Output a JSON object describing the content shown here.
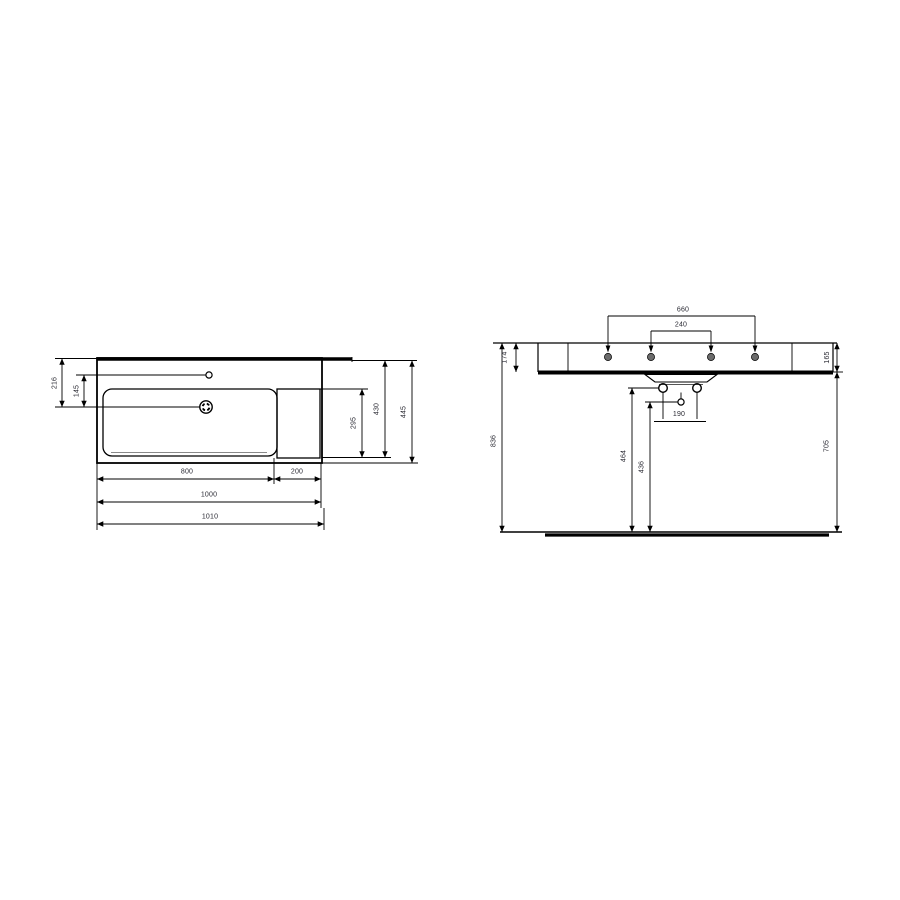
{
  "drawing": {
    "subject": "wall-hung washbasin technical drawing (plan view and front elevation)",
    "plan": {
      "bowl_width": "800",
      "deck_width": "200",
      "basin_width": "1000",
      "overall_width": "1010",
      "rear_to_drain": "216",
      "tap_to_drain": "145",
      "bowl_depth": "295",
      "inner_depth": "430",
      "overall_depth": "445"
    },
    "front": {
      "tap_hole_span": "660",
      "tap_hole_inner_span": "240",
      "rim_height_left": "174",
      "rim_height_right": "165",
      "floor_to_rim": "836",
      "floor_to_underside": "705",
      "fixing_hole_span": "190",
      "fixing_hole_height": "464",
      "outlet_height": "436"
    }
  }
}
